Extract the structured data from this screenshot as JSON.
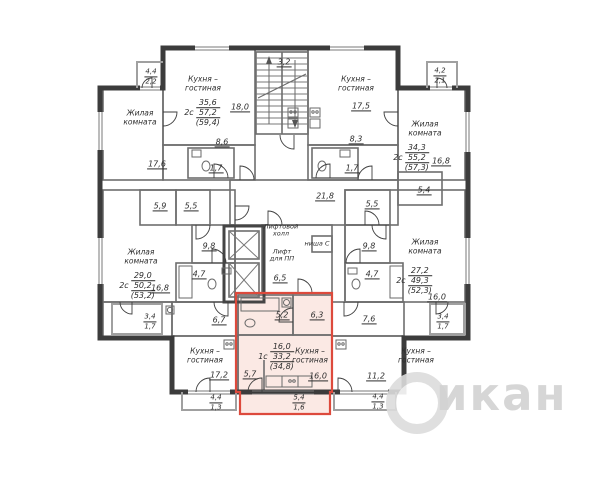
{
  "colors": {
    "highlight_stroke": "#dd4a3c",
    "highlight_fill": "#fbe9e4",
    "watermark": "#d2d2d2"
  },
  "watermark": {
    "text": "икан"
  },
  "plan": {
    "room_names": [
      {
        "x": 203,
        "y": 84,
        "lines": [
          "Кухня –",
          "гостиная"
        ]
      },
      {
        "x": 140,
        "y": 118,
        "lines": [
          "Жилая",
          "комната"
        ]
      },
      {
        "x": 356,
        "y": 84,
        "lines": [
          "Кухня –",
          "гостиная"
        ]
      },
      {
        "x": 425,
        "y": 129,
        "lines": [
          "Жилая",
          "комната"
        ]
      },
      {
        "x": 141,
        "y": 257,
        "lines": [
          "Жилая",
          "комната"
        ]
      },
      {
        "x": 425,
        "y": 247,
        "lines": [
          "Жилая",
          "комната"
        ]
      },
      {
        "x": 205,
        "y": 356,
        "lines": [
          "Кухня –",
          "гостиная"
        ]
      },
      {
        "x": 310,
        "y": 356,
        "lines": [
          "Кухня –",
          "гостиная"
        ]
      },
      {
        "x": 416,
        "y": 356,
        "lines": [
          "Кухня –",
          "гостиная"
        ]
      },
      {
        "x": 281,
        "y": 231,
        "small": true,
        "lines": [
          "Лифтовой",
          "холл"
        ]
      },
      {
        "x": 282,
        "y": 256,
        "small": true,
        "lines": [
          "Лифт",
          "для ПП"
        ]
      },
      {
        "x": 317,
        "y": 244,
        "small": true,
        "lines": [
          "ниша С"
        ]
      }
    ],
    "areas": [
      {
        "x": 240,
        "y": 107,
        "v": "18,0"
      },
      {
        "x": 222,
        "y": 142,
        "v": "8,6"
      },
      {
        "x": 216,
        "y": 168,
        "v": "1,7"
      },
      {
        "x": 157,
        "y": 164,
        "v": "17,6"
      },
      {
        "x": 284,
        "y": 62,
        "v": "3,2"
      },
      {
        "x": 361,
        "y": 106,
        "v": "17,5"
      },
      {
        "x": 356,
        "y": 139,
        "v": "8,3"
      },
      {
        "x": 352,
        "y": 168,
        "v": "1,7"
      },
      {
        "x": 441,
        "y": 161,
        "v": "16,8"
      },
      {
        "x": 325,
        "y": 196,
        "v": "21,8"
      },
      {
        "x": 280,
        "y": 278,
        "v": "6,5"
      },
      {
        "x": 160,
        "y": 206,
        "v": "5,9"
      },
      {
        "x": 191,
        "y": 206,
        "v": "5,5"
      },
      {
        "x": 209,
        "y": 246,
        "v": "9,8"
      },
      {
        "x": 199,
        "y": 274,
        "v": "4,7"
      },
      {
        "x": 160,
        "y": 288,
        "v": "16,8"
      },
      {
        "x": 424,
        "y": 190,
        "v": "5,4"
      },
      {
        "x": 372,
        "y": 204,
        "v": "5,5"
      },
      {
        "x": 369,
        "y": 246,
        "v": "9,8"
      },
      {
        "x": 372,
        "y": 274,
        "v": "4,7"
      },
      {
        "x": 437,
        "y": 297,
        "v": "16,0"
      },
      {
        "x": 369,
        "y": 319,
        "v": "7,6"
      },
      {
        "x": 219,
        "y": 320,
        "v": "6,7"
      },
      {
        "x": 219,
        "y": 375,
        "v": "17,2"
      },
      {
        "x": 282,
        "y": 315,
        "v": "5,2"
      },
      {
        "x": 317,
        "y": 315,
        "v": "6,3"
      },
      {
        "x": 250,
        "y": 374,
        "v": "5,7"
      },
      {
        "x": 318,
        "y": 376,
        "v": "16,0"
      },
      {
        "x": 376,
        "y": 376,
        "v": "11,2"
      }
    ],
    "stacks": [
      {
        "x": 151,
        "y": 77,
        "top": "4,4",
        "bottom": "2,2"
      },
      {
        "x": 440,
        "y": 76,
        "top": "4,2",
        "bottom": "2,1"
      },
      {
        "x": 150,
        "y": 322,
        "top": "3,4",
        "bottom": "1,7"
      },
      {
        "x": 443,
        "y": 322,
        "top": "3,4",
        "bottom": "1,7"
      },
      {
        "x": 216,
        "y": 403,
        "top": "4,4",
        "bottom": "1,3"
      },
      {
        "x": 299,
        "y": 403,
        "top": "5,4",
        "bottom": "1,6"
      },
      {
        "x": 378,
        "y": 402,
        "top": "4,4",
        "bottom": "1,3"
      }
    ],
    "summaries": [
      {
        "x": 202,
        "y": 113,
        "type": "2с",
        "living": "35,6",
        "total": "57,2",
        "with_balcony": "(59,4)"
      },
      {
        "x": 411,
        "y": 158,
        "type": "2с",
        "living": "34,3",
        "total": "55,2",
        "with_balcony": "(57,3)"
      },
      {
        "x": 137,
        "y": 286,
        "type": "2с",
        "living": "29,0",
        "total": "50,2",
        "with_balcony": "(53,2)"
      },
      {
        "x": 414,
        "y": 281,
        "type": "2с",
        "living": "27,2",
        "total": "49,3",
        "with_balcony": "(52,3)"
      },
      {
        "x": 276,
        "y": 357,
        "type": "1с",
        "living": "16,0",
        "total": "33,2",
        "with_balcony": "(34,8)"
      }
    ]
  }
}
